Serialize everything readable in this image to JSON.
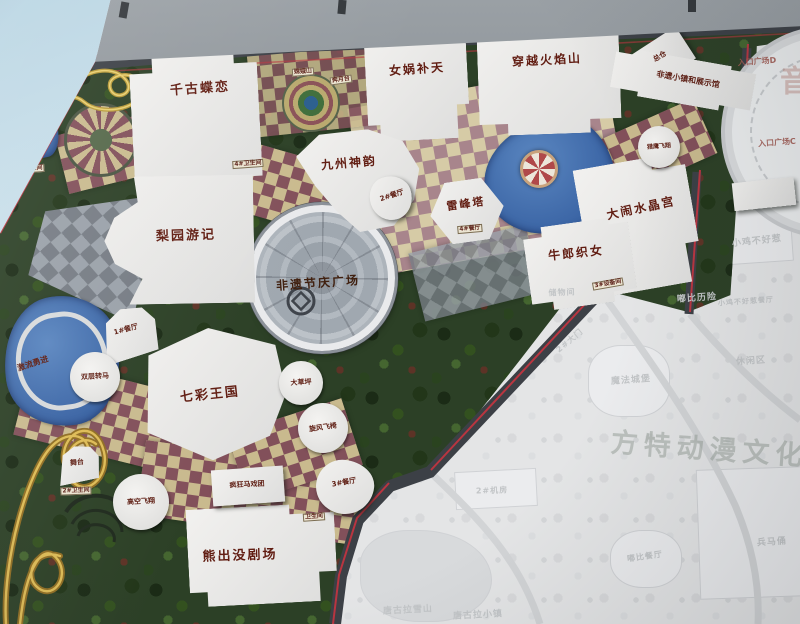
{
  "map": {
    "watermark": "方特动漫文化科",
    "side_text": "音",
    "colors": {
      "trim_red": "#b93540",
      "label_red": "#611d12",
      "park_green": "#2c4026",
      "path_tan": "#c9ba8e",
      "path_maroon": "#82505a",
      "water_blue": "#3f6ea8",
      "faded_gray": "#e4e5e6",
      "frame_gray": "#6e747a",
      "sky_blue": "#b9d5e3"
    },
    "labels": [
      {
        "k": "watermark",
        "t": "方特动漫文化科",
        "x": 726,
        "y": 451,
        "s": 27,
        "r": 4
      },
      {
        "k": "music",
        "t": "音",
        "x": 791,
        "y": 84,
        "s": 30,
        "r": 0
      },
      {
        "k": "major",
        "t": "千古蝶恋",
        "x": 200,
        "y": 89,
        "s": 13,
        "r": -4
      },
      {
        "k": "major",
        "t": "女娲补天",
        "x": 417,
        "y": 69,
        "s": 12,
        "r": -4
      },
      {
        "k": "major",
        "t": "穿越火焰山",
        "x": 547,
        "y": 60,
        "s": 12,
        "r": -3
      },
      {
        "k": "major",
        "t": "九州神韵",
        "x": 349,
        "y": 163,
        "s": 12,
        "r": -5
      },
      {
        "k": "major",
        "t": "梨园游记",
        "x": 186,
        "y": 236,
        "s": 13,
        "r": -2
      },
      {
        "k": "major",
        "t": "雷峰塔",
        "x": 466,
        "y": 204,
        "s": 11,
        "r": -8
      },
      {
        "k": "major",
        "t": "大闹水晶宫",
        "x": 641,
        "y": 208,
        "s": 12,
        "r": -12
      },
      {
        "k": "major",
        "t": "牛郎织女",
        "x": 576,
        "y": 253,
        "s": 12,
        "r": -6
      },
      {
        "k": "plaza",
        "t": "非遗节庆广场",
        "x": 318,
        "y": 283,
        "s": 12,
        "r": -4
      },
      {
        "k": "major",
        "t": "七彩王国",
        "x": 210,
        "y": 395,
        "s": 13,
        "r": -6
      },
      {
        "k": "major",
        "t": "熊出没剧场",
        "x": 240,
        "y": 556,
        "s": 13,
        "r": -2
      },
      {
        "k": "small",
        "t": "激流勇进",
        "x": 33,
        "y": 364,
        "s": 8,
        "r": -18
      },
      {
        "k": "small",
        "t": "双层转马",
        "x": 95,
        "y": 377,
        "s": 7,
        "r": -3
      },
      {
        "k": "small",
        "t": "1#餐厅",
        "x": 126,
        "y": 330,
        "s": 7,
        "r": -15
      },
      {
        "k": "small",
        "t": "大草坪",
        "x": 301,
        "y": 383,
        "s": 7,
        "r": -3
      },
      {
        "k": "small",
        "t": "旋风飞椅",
        "x": 323,
        "y": 428,
        "s": 7,
        "r": -8
      },
      {
        "k": "small",
        "t": "舞台",
        "x": 77,
        "y": 463,
        "s": 7,
        "r": -6
      },
      {
        "k": "small",
        "t": "高空飞翔",
        "x": 141,
        "y": 502,
        "s": 7,
        "r": -3
      },
      {
        "k": "small",
        "t": "疯狂马戏团",
        "x": 247,
        "y": 485,
        "s": 7,
        "r": -3
      },
      {
        "k": "small",
        "t": "3#餐厅",
        "x": 344,
        "y": 483,
        "s": 7,
        "r": -10
      },
      {
        "k": "small",
        "t": "2#餐厅",
        "x": 392,
        "y": 196,
        "s": 7,
        "r": -18
      },
      {
        "k": "small",
        "t": "猎鹰飞翔",
        "x": 659,
        "y": 147,
        "s": 6,
        "r": -4
      },
      {
        "k": "small",
        "t": "总仓",
        "x": 660,
        "y": 57,
        "s": 7,
        "r": -30
      },
      {
        "k": "small",
        "t": "非遗小镇和展示馆",
        "x": 688,
        "y": 80,
        "s": 8,
        "r": 10
      },
      {
        "k": "chip",
        "t": "1#机房",
        "x": 278,
        "y": 47,
        "s": 6,
        "r": -4
      },
      {
        "k": "chip",
        "t": "配电房",
        "x": 319,
        "y": 45,
        "s": 6,
        "r": -4
      },
      {
        "k": "chip",
        "t": "嫦娥山",
        "x": 303,
        "y": 72,
        "s": 6,
        "r": -4
      },
      {
        "k": "chip",
        "t": "奔月台",
        "x": 341,
        "y": 80,
        "s": 6,
        "r": -8
      },
      {
        "k": "chip",
        "t": "1#卫生间",
        "x": 29,
        "y": 169,
        "s": 6,
        "r": -4
      },
      {
        "k": "chip",
        "t": "4#卫生间",
        "x": 248,
        "y": 164,
        "s": 6,
        "r": -4
      },
      {
        "k": "chip",
        "t": "2#卫生间",
        "x": 76,
        "y": 491,
        "s": 6,
        "r": -2
      },
      {
        "k": "chip",
        "t": "卫生间",
        "x": 314,
        "y": 517,
        "s": 6,
        "r": -4
      },
      {
        "k": "chip",
        "t": "4#餐厅",
        "x": 470,
        "y": 229,
        "s": 6,
        "r": -5
      },
      {
        "k": "chip",
        "t": "3#设备间",
        "x": 608,
        "y": 284,
        "s": 6,
        "r": -10
      },
      {
        "k": "entrance",
        "t": "入口广场E",
        "x": 772,
        "y": 16,
        "s": 8,
        "r": -4
      },
      {
        "k": "entrance",
        "t": "入口广场D",
        "x": 757,
        "y": 62,
        "s": 8,
        "r": -4
      },
      {
        "k": "entrance",
        "t": "入口广场C",
        "x": 777,
        "y": 143,
        "s": 8,
        "r": -4
      },
      {
        "k": "ghost",
        "t": "储物间",
        "x": 562,
        "y": 293,
        "s": 8,
        "r": -2
      },
      {
        "k": "ghost",
        "t": "小鸡不好惹",
        "x": 757,
        "y": 242,
        "s": 9,
        "r": -6
      },
      {
        "k": "ghost",
        "t": "嘟比历险",
        "x": 697,
        "y": 299,
        "s": 9,
        "r": -4
      },
      {
        "k": "ghost",
        "t": "小鸡不好惹餐厅",
        "x": 746,
        "y": 302,
        "s": 7,
        "r": -4
      },
      {
        "k": "ghost",
        "t": "休闲区",
        "x": 751,
        "y": 362,
        "s": 9,
        "r": -4
      },
      {
        "k": "ghost",
        "t": "魔法城堡",
        "x": 631,
        "y": 381,
        "s": 9,
        "r": -4
      },
      {
        "k": "ghost",
        "t": "2#大门",
        "x": 570,
        "y": 341,
        "s": 8,
        "r": -40
      },
      {
        "k": "ghost",
        "t": "2#机房",
        "x": 492,
        "y": 491,
        "s": 8,
        "r": -2
      },
      {
        "k": "ghost",
        "t": "兵马俑",
        "x": 772,
        "y": 543,
        "s": 9,
        "r": -4
      },
      {
        "k": "ghost",
        "t": "嘟比餐厅",
        "x": 645,
        "y": 557,
        "s": 8,
        "r": -8
      },
      {
        "k": "ghost",
        "t": "唐古拉雪山",
        "x": 408,
        "y": 611,
        "s": 9,
        "r": -3
      },
      {
        "k": "ghost",
        "t": "唐古拉小镇",
        "x": 478,
        "y": 616,
        "s": 9,
        "r": -3
      }
    ],
    "buildings": [
      {
        "x": 132,
        "y": 54,
        "w": 128,
        "h": 142,
        "r": -3,
        "k": "step1"
      },
      {
        "x": 366,
        "y": 28,
        "w": 102,
        "h": 112,
        "r": -3,
        "k": "step2"
      },
      {
        "x": 478,
        "y": 20,
        "w": 142,
        "h": 114,
        "r": -2,
        "k": "step1"
      },
      {
        "x": 636,
        "y": 38,
        "w": 54,
        "h": 38,
        "r": -33,
        "k": "rect"
      },
      {
        "x": 298,
        "y": 130,
        "w": 122,
        "h": 102,
        "r": -4,
        "k": "fan"
      },
      {
        "x": 84,
        "y": 176,
        "w": 170,
        "h": 128,
        "r": -1,
        "k": "liyuan"
      },
      {
        "x": 430,
        "y": 180,
        "w": 74,
        "h": 62,
        "r": -8,
        "k": "hex"
      },
      {
        "x": 583,
        "y": 160,
        "w": 112,
        "h": 130,
        "r": -10,
        "k": "step2"
      },
      {
        "x": 527,
        "y": 222,
        "w": 106,
        "h": 84,
        "r": -8,
        "k": "step1"
      },
      {
        "x": 138,
        "y": 328,
        "w": 148,
        "h": 132,
        "r": -6,
        "k": "poly7"
      },
      {
        "x": 188,
        "y": 506,
        "w": 148,
        "h": 98,
        "r": -3,
        "k": "step2"
      },
      {
        "x": 98,
        "y": 308,
        "w": 60,
        "h": 50,
        "r": -18,
        "k": "wedge"
      },
      {
        "x": 316,
        "y": 460,
        "w": 58,
        "h": 54,
        "r": 6,
        "k": "blob"
      },
      {
        "x": 212,
        "y": 468,
        "w": 72,
        "h": 36,
        "r": -4,
        "k": "rect"
      },
      {
        "x": 56,
        "y": 446,
        "w": 44,
        "h": 36,
        "r": -12,
        "k": "wedge"
      },
      {
        "x": 370,
        "y": 176,
        "w": 42,
        "h": 44,
        "r": -18,
        "k": "blob"
      },
      {
        "x": 612,
        "y": 58,
        "w": 142,
        "h": 46,
        "r": 10,
        "k": "step1"
      },
      {
        "x": 733,
        "y": 180,
        "w": 62,
        "h": 28,
        "r": -6,
        "k": "rect"
      }
    ],
    "ride_circles": [
      {
        "x": 95,
        "y": 377,
        "rad": 25
      },
      {
        "x": 301,
        "y": 383,
        "rad": 22
      },
      {
        "x": 323,
        "y": 428,
        "rad": 25
      },
      {
        "x": 141,
        "y": 502,
        "rad": 28
      },
      {
        "x": 659,
        "y": 147,
        "rad": 21
      }
    ]
  }
}
